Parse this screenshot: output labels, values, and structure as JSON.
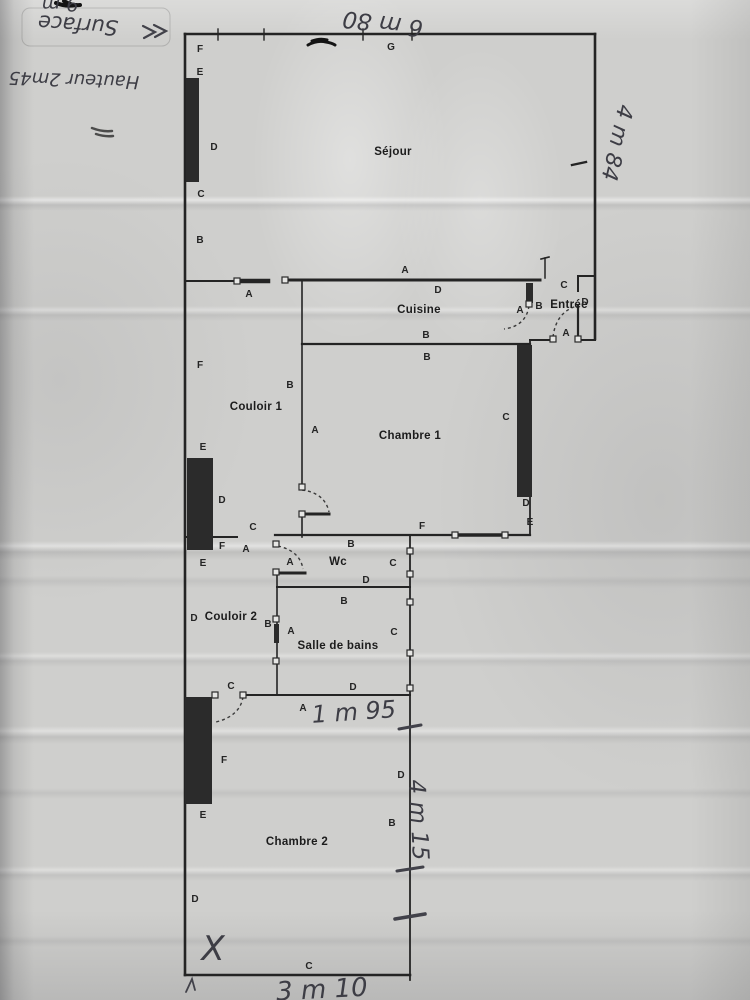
{
  "document_type": "scanned hand-annotated floor plan",
  "handwriting": {
    "surface_fragment": "9 m",
    "surface_label": "Surface",
    "hauteur_label": "Hauteur 2m45",
    "dim_top": "6 m 80",
    "dim_right": "4 m 84",
    "dim_middle": "1 m 95",
    "dim_lower_right": "4 m 15",
    "dim_bottom": "3 m 10",
    "x_mark": "X"
  },
  "plan": {
    "rooms": [
      {
        "name": "Séjour",
        "x": 393,
        "y": 155
      },
      {
        "name": "Cuisine",
        "x": 419,
        "y": 313
      },
      {
        "name": "Entrée",
        "x": 569,
        "y": 308
      },
      {
        "name": "Couloir 1",
        "x": 256,
        "y": 410
      },
      {
        "name": "Chambre 1",
        "x": 410,
        "y": 439
      },
      {
        "name": "Wc",
        "x": 338,
        "y": 565
      },
      {
        "name": "Couloir 2",
        "x": 231,
        "y": 620
      },
      {
        "name": "Salle de bains",
        "x": 338,
        "y": 649
      },
      {
        "name": "Chambre 2",
        "x": 297,
        "y": 845
      }
    ],
    "wall_letters": [
      {
        "t": "G",
        "x": 391,
        "y": 50
      },
      {
        "t": "F",
        "x": 200,
        "y": 52
      },
      {
        "t": "E",
        "x": 200,
        "y": 75
      },
      {
        "t": "D",
        "x": 214,
        "y": 150
      },
      {
        "t": "C",
        "x": 201,
        "y": 197
      },
      {
        "t": "B",
        "x": 200,
        "y": 243
      },
      {
        "t": "A",
        "x": 249,
        "y": 297
      },
      {
        "t": "A",
        "x": 405,
        "y": 273
      },
      {
        "t": "D",
        "x": 438,
        "y": 293
      },
      {
        "t": "C",
        "x": 564,
        "y": 288
      },
      {
        "t": "D",
        "x": 585,
        "y": 305
      },
      {
        "t": "B",
        "x": 539,
        "y": 309
      },
      {
        "t": "A",
        "x": 520,
        "y": 313
      },
      {
        "t": "A",
        "x": 566,
        "y": 336
      },
      {
        "t": "B",
        "x": 426,
        "y": 338
      },
      {
        "t": "B",
        "x": 427,
        "y": 360
      },
      {
        "t": "F",
        "x": 200,
        "y": 368
      },
      {
        "t": "B",
        "x": 290,
        "y": 388
      },
      {
        "t": "A",
        "x": 315,
        "y": 433
      },
      {
        "t": "E",
        "x": 203,
        "y": 450
      },
      {
        "t": "D",
        "x": 222,
        "y": 503
      },
      {
        "t": "C",
        "x": 253,
        "y": 530
      },
      {
        "t": "F",
        "x": 222,
        "y": 549
      },
      {
        "t": "A",
        "x": 246,
        "y": 552
      },
      {
        "t": "E",
        "x": 203,
        "y": 566
      },
      {
        "t": "C",
        "x": 506,
        "y": 420
      },
      {
        "t": "D",
        "x": 526,
        "y": 506
      },
      {
        "t": "E",
        "x": 530,
        "y": 525
      },
      {
        "t": "F",
        "x": 422,
        "y": 529
      },
      {
        "t": "B",
        "x": 351,
        "y": 547
      },
      {
        "t": "A",
        "x": 290,
        "y": 565
      },
      {
        "t": "C",
        "x": 393,
        "y": 566
      },
      {
        "t": "D",
        "x": 366,
        "y": 583
      },
      {
        "t": "B",
        "x": 344,
        "y": 604
      },
      {
        "t": "D",
        "x": 194,
        "y": 621
      },
      {
        "t": "B",
        "x": 268,
        "y": 627
      },
      {
        "t": "A",
        "x": 291,
        "y": 634
      },
      {
        "t": "C",
        "x": 394,
        "y": 635
      },
      {
        "t": "D",
        "x": 353,
        "y": 690
      },
      {
        "t": "C",
        "x": 231,
        "y": 689
      },
      {
        "t": "A",
        "x": 303,
        "y": 711
      },
      {
        "t": "F",
        "x": 224,
        "y": 763
      },
      {
        "t": "E",
        "x": 203,
        "y": 818
      },
      {
        "t": "D",
        "x": 195,
        "y": 902
      },
      {
        "t": "D",
        "x": 401,
        "y": 778
      },
      {
        "t": "B",
        "x": 392,
        "y": 826
      },
      {
        "t": "C",
        "x": 309,
        "y": 969
      }
    ]
  },
  "colors": {
    "paper": "#cfcfcd",
    "wall_ink": "#242424",
    "pencil": "#42424a"
  }
}
